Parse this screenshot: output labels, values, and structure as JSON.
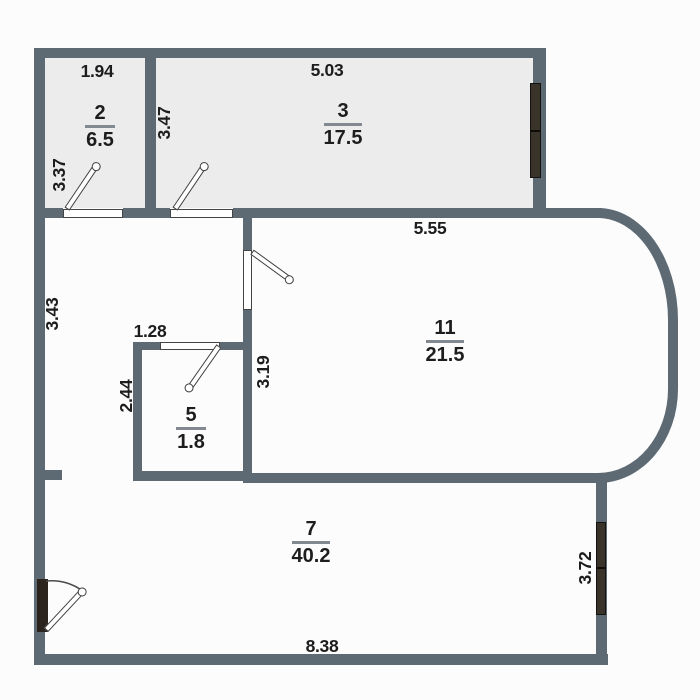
{
  "title": "apartment-floor-plan",
  "colors": {
    "bg": "#fcfcfc",
    "wall": "#5d6973",
    "room-fill": "#ececec",
    "window": "#3a3329",
    "door-dark": "#2a231e",
    "label": "#1d1d1d",
    "fraction-line": "#828990"
  },
  "rooms": {
    "room2": {
      "number": "2",
      "area": "6.5"
    },
    "room3": {
      "number": "3",
      "area": "17.5"
    },
    "room5": {
      "number": "5",
      "area": "1.8"
    },
    "room7": {
      "number": "7",
      "area": "40.2"
    },
    "room11": {
      "number": "11",
      "area": "21.5"
    }
  },
  "dimensions": {
    "room2_width": "1.94",
    "room2_left": "3.37",
    "room3_top": "5.03",
    "room3_left": "3.47",
    "hall_left": "3.43",
    "room11_top": "5.55",
    "room11_left": "3.19",
    "room5_top": "1.28",
    "room5_left": "2.44",
    "room7_bottom": "8.38",
    "room7_right": "3.72"
  }
}
